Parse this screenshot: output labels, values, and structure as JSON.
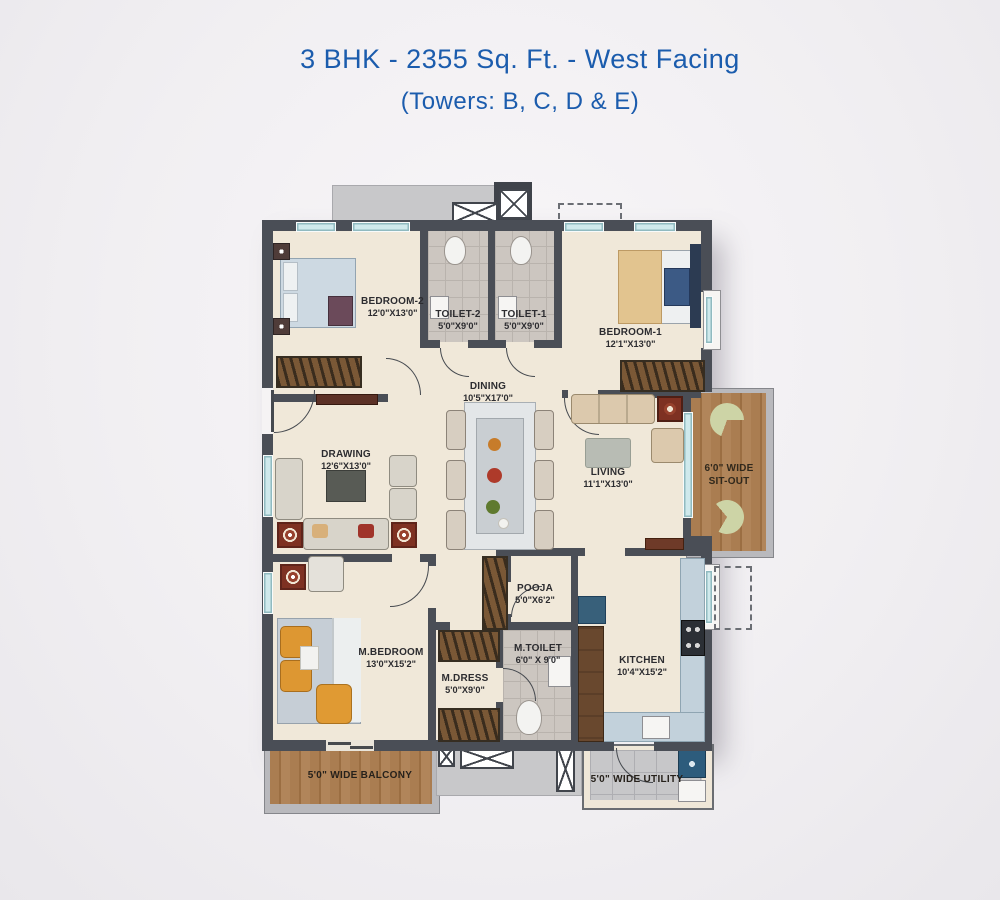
{
  "title": {
    "line1": "3 BHK - 2355 Sq. Ft. - West Facing",
    "line2": "(Towers: B, C, D & E)"
  },
  "colors": {
    "title_blue": "#1b5cad",
    "wall": "#4a4e56",
    "floor_cream": "#f0e8d9",
    "toilet_tile": "#ccc6c0",
    "corridor_gray": "#c8c8ca",
    "wood": "#a87c50",
    "window_glass": "#cfe9ec",
    "accent_red": "#7e3122"
  },
  "rooms": {
    "bedroom2": {
      "name": "BEDROOM-2",
      "dims": "12'0\"X13'0\""
    },
    "toilet2": {
      "name": "TOILET-2",
      "dims": "5'0\"X9'0\""
    },
    "toilet1": {
      "name": "TOILET-1",
      "dims": "5'0\"X9'0\""
    },
    "bedroom1": {
      "name": "BEDROOM-1",
      "dims": "12'1\"X13'0\""
    },
    "dining": {
      "name": "DINING",
      "dims": "10'5\"X17'0\""
    },
    "drawing": {
      "name": "DRAWING",
      "dims": "12'6\"X13'0\""
    },
    "living": {
      "name": "LIVING",
      "dims": "11'1\"X13'0\""
    },
    "sitout": {
      "line1": "6'0\" WIDE",
      "line2": "SIT-OUT"
    },
    "pooja": {
      "name": "POOJA",
      "dims": "5'0\"X6'2\""
    },
    "mtoilet": {
      "name": "M.TOILET",
      "dims": "6'0\" X 9'0\""
    },
    "mdress": {
      "name": "M.DRESS",
      "dims": "5'0\"X9'0\""
    },
    "mbedroom": {
      "name": "M.BEDROOM",
      "dims": "13'0\"X15'2\""
    },
    "kitchen": {
      "name": "KITCHEN",
      "dims": "10'4\"X15'2\""
    },
    "balcony": {
      "label": "5'0\" WIDE BALCONY"
    },
    "utility": {
      "label": "5'0\" WIDE UTILITY"
    }
  }
}
